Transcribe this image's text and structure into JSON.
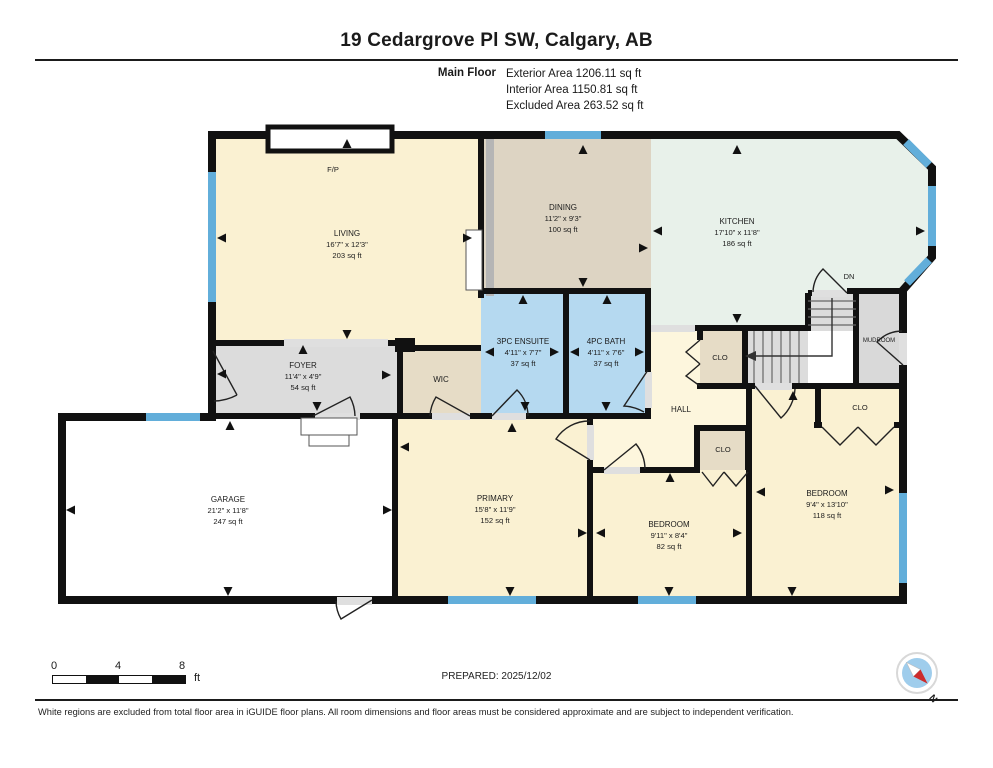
{
  "header": {
    "title": "19 Cedargrove Pl SW, Calgary, AB",
    "floor_label": "Main Floor",
    "area_lines": [
      "Exterior Area 1206.11 sq ft",
      "Interior Area 1150.81 sq ft",
      "Excluded Area 263.52 sq ft"
    ]
  },
  "rooms": {
    "living": {
      "name": "LIVING",
      "dims": "16'7\" x 12'3\"",
      "area": "203 sq ft"
    },
    "dining": {
      "name": "DINING",
      "dims": "11'2\" x 9'3\"",
      "area": "100 sq ft"
    },
    "kitchen": {
      "name": "KITCHEN",
      "dims": "17'10\" x 11'8\"",
      "area": "186 sq ft"
    },
    "ensuite": {
      "name": "3PC ENSUITE",
      "dims": "4'11\" x 7'7\"",
      "area": "37 sq ft"
    },
    "bath": {
      "name": "4PC BATH",
      "dims": "4'11\" x 7'6\"",
      "area": "37 sq ft"
    },
    "foyer": {
      "name": "FOYER",
      "dims": "11'4\" x 4'9\"",
      "area": "54 sq ft"
    },
    "wic": {
      "name": "WIC"
    },
    "hall": {
      "name": "HALL"
    },
    "mudroom": {
      "name": "MUDROOM"
    },
    "garage": {
      "name": "GARAGE",
      "dims": "21'2\" x 11'8\"",
      "area": "247 sq ft"
    },
    "primary": {
      "name": "PRIMARY",
      "dims": "15'8\" x 11'9\"",
      "area": "152 sq ft"
    },
    "bedroom2": {
      "name": "BEDROOM",
      "dims": "9'11\" x 8'4\"",
      "area": "82 sq ft"
    },
    "bedroom3": {
      "name": "BEDROOM",
      "dims": "9'4\" x 13'10\"",
      "area": "118 sq ft"
    }
  },
  "labels": {
    "clo": "CLO",
    "fireplace": "F/P",
    "stairs_down": "DN"
  },
  "scale_bar": {
    "tick0": "0",
    "tick4": "4",
    "tick8": "8",
    "unit": "ft"
  },
  "footer": {
    "prepared": "PREPARED: 2025/12/02",
    "disclaimer": "White regions are excluded from total floor area in iGUIDE floor plans. All room dimensions and floor areas must be considered approximate and are subject to independent verification.",
    "compass_label": "N"
  },
  "colors": {
    "wall": "#111111",
    "window_blue": "#62aeda",
    "room_cream": "#faf1d2",
    "hall_cream": "#fdf6dd",
    "room_tan": "#ddd4c3",
    "closet_tan": "#e6dcc6",
    "kitchen_mint": "#e8f1ea",
    "bath_blue": "#b5d9f0",
    "gray_floor": "#dcdcdc",
    "excluded_white": "#ffffff",
    "compass_red": "#cc2b2b"
  }
}
